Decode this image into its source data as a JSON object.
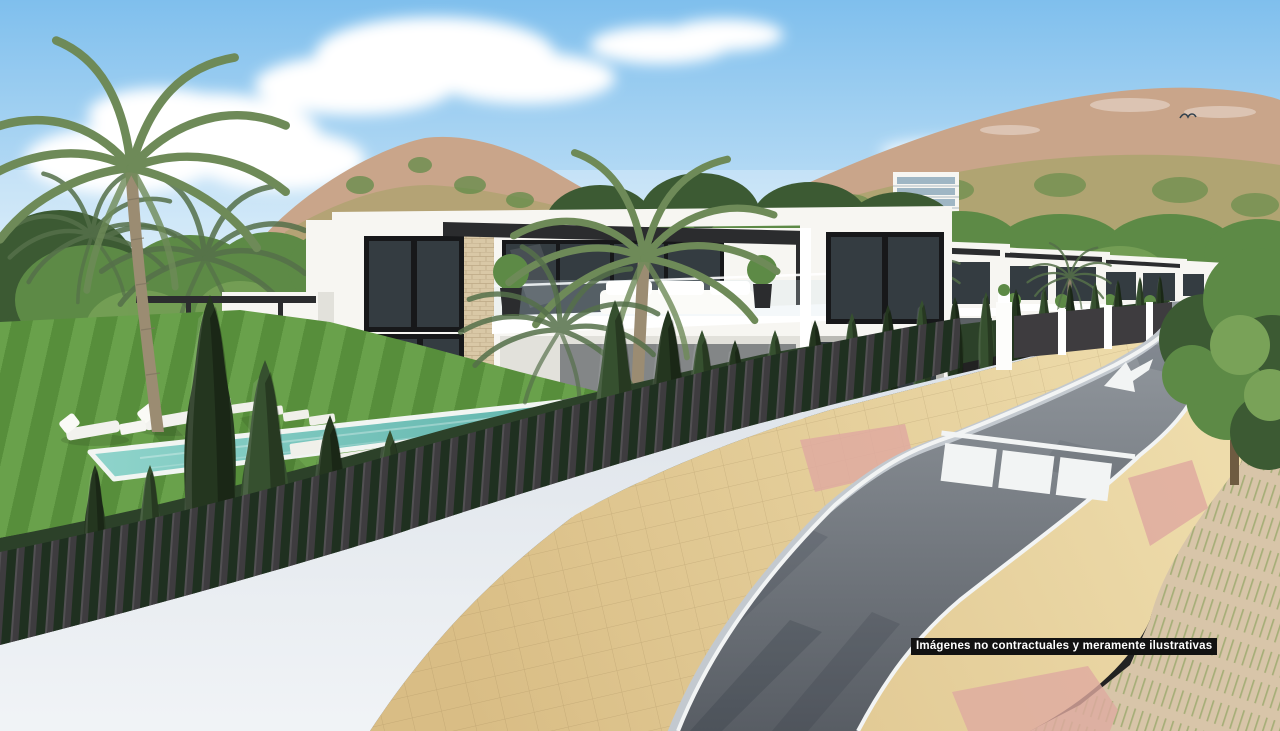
{
  "overlay": {
    "disclaimer": "Imágenes no contractuales y meramente ilustrativas"
  },
  "icons": {
    "road_arrow": "white lane arrow pointing lower-left",
    "crosswalk": "three white zebra stripes with stop line",
    "bird": "bird silhouette in sky"
  },
  "palette": {
    "sky_top": "#7fbfed",
    "sky_horizon": "#e6f3fb",
    "cloud_white": "#ffffff",
    "hill_rock": "#c9a58a",
    "hill_olive": "#a3a365",
    "tree_green": "#5d8a46",
    "tree_dark": "#3c5a33",
    "tree_light": "#79a258",
    "cypress_green": "#36502f",
    "cypress_dark": "#24361f",
    "hedge_green": "#2c4129",
    "hedge_dark": "#1f3020",
    "villa_white": "#f7f6f2",
    "villa_shade": "#e2e1db",
    "glass_dark": "#343c41",
    "frame_black": "#17181a",
    "stone_beige": "#d9c8a6",
    "pergola_dark": "#2b2c2e",
    "lawn_green": "#578e3b",
    "lawn_light": "#69a14b",
    "lawn_mid": "#7fa85c",
    "pool_aqua": "#8fd4cb",
    "pool_deep": "#5fb3ab",
    "pool_white": "#f1f5f2",
    "fence_dark": "#3e3c3f",
    "wall_white": "#f0f3f6",
    "wall_shade": "#dbe1e8",
    "road_near": "#585d64",
    "road_far": "#9aa0a6",
    "marking_white": "#f2f4f4",
    "curb_gray": "#c3c9cf",
    "tan_near": "#d9bd85",
    "tan_far": "#eedcab",
    "pink_tile": "#dfaaa0",
    "dirt_sand": "#d8c5a9",
    "grass_streak": "#9aa96b",
    "trunk_brown": "#9b8c72",
    "palm_green": "#6e8a58",
    "palm_dark": "#55704a",
    "badge_bg": "#121212",
    "badge_text": "#ffffff"
  }
}
